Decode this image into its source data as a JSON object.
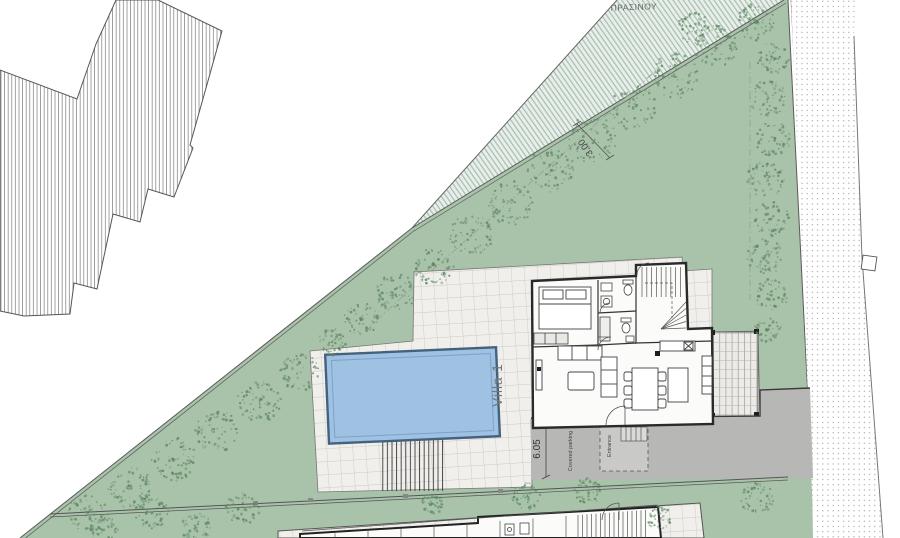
{
  "plan": {
    "labels": {
      "green_strip": "ΠΡΑΣΙΝΟΥ",
      "green_strip_width": "3.00",
      "villa_name": "Villa 1",
      "driveway_width": "6.05",
      "covered_parking": "Covered parking",
      "entrance": "Entrance"
    },
    "colors": {
      "garden_green": "#a8c3aa",
      "tree_dot_green": "#5f8763",
      "hatch_green": "#9cc2ae",
      "pool_fill": "#9fc1e2",
      "pool_border": "#44627e",
      "pool_inner_line": "#7aa3cc",
      "tile_background": "#f0efeb",
      "tile_line": "#cbcac4",
      "driveway_gray": "#b7b7b5",
      "wall_dark": "#2a2a2a",
      "boundary_line": "#5a5a5a",
      "road_stipple": "#9a9a9a",
      "label_text": "#666666"
    }
  }
}
